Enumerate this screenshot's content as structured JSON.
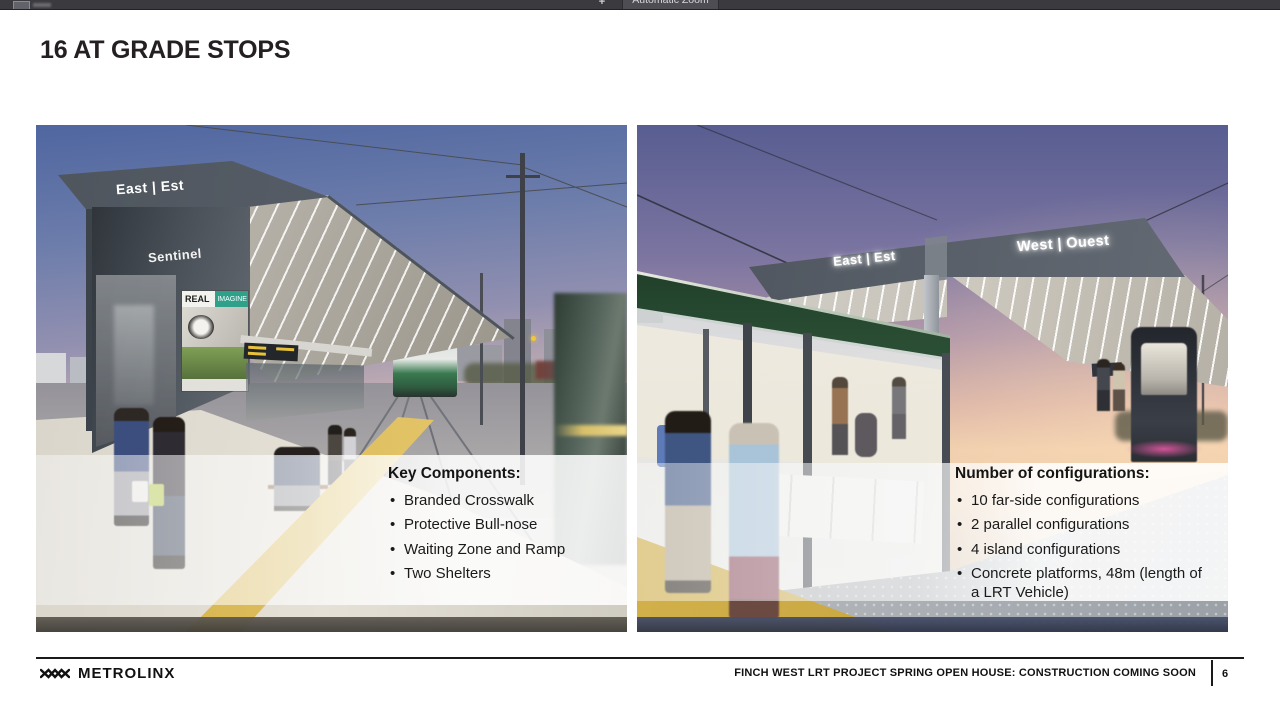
{
  "viewer": {
    "zoom_in_label": "+",
    "zoom_control_label": "Automatic Zoom"
  },
  "slide": {
    "title": "16 AT GRADE STOPS",
    "left_panel": {
      "signs": {
        "canopy": "East | Est",
        "station": "Sentinel",
        "ad_word_1": "REAL",
        "ad_word_2": "IMAGINE"
      },
      "overlay": {
        "heading": "Key Components:",
        "bullets": [
          "Branded Crosswalk",
          "Protective Bull-nose",
          "Waiting Zone and Ramp",
          "Two Shelters"
        ]
      }
    },
    "right_panel": {
      "signs": {
        "east": "East | Est",
        "west": "West | Ouest"
      },
      "overlay": {
        "heading": "Number of configurations:",
        "bullets": [
          "10 far-side configurations",
          "2 parallel configurations",
          "4 island configurations",
          "Concrete platforms, 48m (length of a LRT Vehicle)"
        ]
      }
    }
  },
  "footer": {
    "brand": "METROLINX",
    "project_line": "FINCH WEST LRT PROJECT SPRING OPEN HOUSE: CONSTRUCTION COMING SOON",
    "page_number": "6"
  },
  "colors": {
    "accent_yellow": "#d8b54e",
    "canopy_gray": "#4e555d",
    "footer_black": "#1a1a1a",
    "toolbar_dark": "#3a3a3f"
  }
}
